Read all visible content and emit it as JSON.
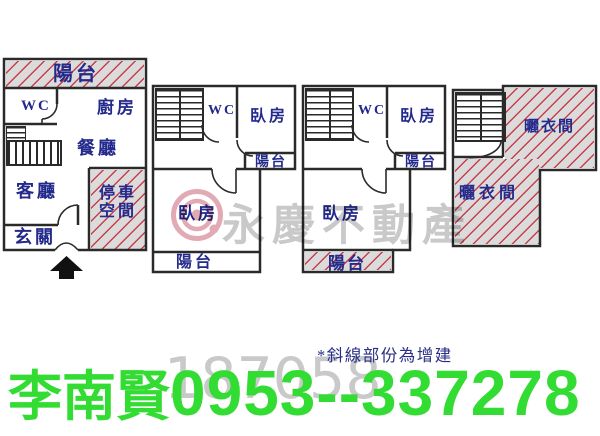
{
  "colors": {
    "wall": "#2a2a2a",
    "room_label": "#232a8c",
    "hatch_bg": "#dbdbdb",
    "hatch_line": "#c82d3c",
    "contact_green": "#33dc33",
    "watermark_gray": "#9c9c9c",
    "logo_pink": "#c4556b"
  },
  "plans": {
    "p1": {
      "balcony": "陽台",
      "wc": "WC",
      "kitchen": "廚房",
      "dining": "餐廳",
      "living": "客廳",
      "parking1": "停車",
      "parking2": "空間",
      "foyer": "玄關"
    },
    "p2": {
      "wc": "WC",
      "bedroom_top": "臥房",
      "balcony_side": "陽台",
      "bedroom": "臥房",
      "balcony": "陽台"
    },
    "p3": {
      "wc": "WC",
      "bedroom_top": "臥房",
      "balcony_side": "陽台",
      "bedroom": "臥房",
      "balcony": "陽台"
    },
    "p4": {
      "drying_top": "曬衣間",
      "drying_bottom": "曬衣間"
    }
  },
  "watermark": {
    "brand": "永慶不動產",
    "photo_id": "187058"
  },
  "footer": {
    "agent": "李南賢",
    "phone": "0953--337278",
    "note": "*斜線部份為增建"
  }
}
